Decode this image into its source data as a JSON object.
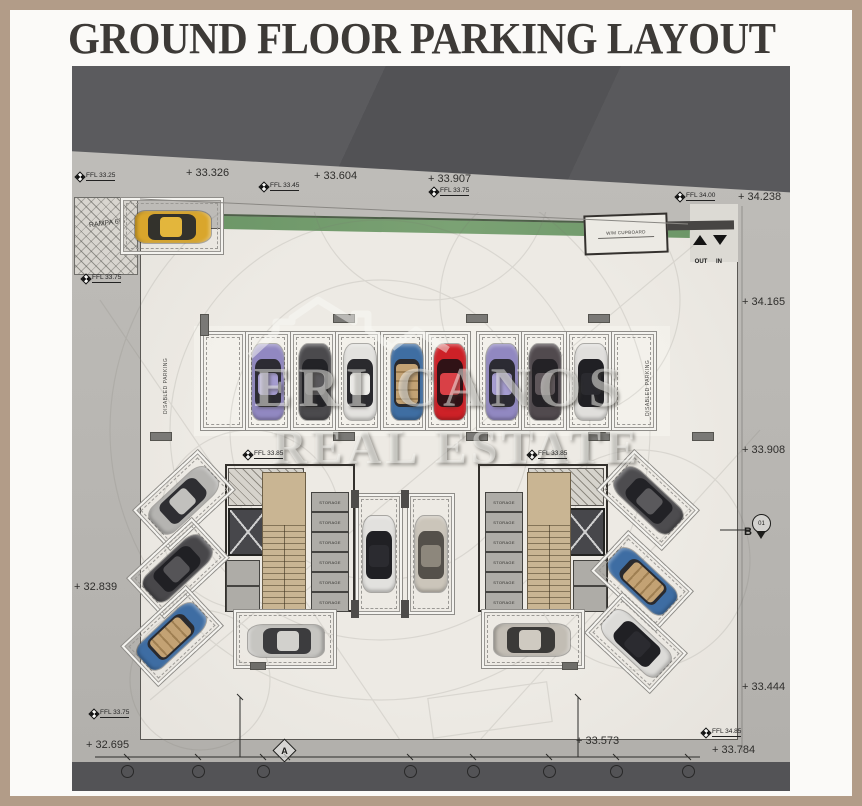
{
  "title": "GROUND FLOOR PARKING LAYOUT",
  "watermark": {
    "line1": "ERI CANOS",
    "line2": "REAL ESTATE"
  },
  "colors": {
    "frame": "#b29c88",
    "page": "#fbfaf8",
    "road": "#b6b4b0",
    "dark_band": "#57575a",
    "floor": "#eae7e1",
    "green_strip": "#6d9768",
    "car_yellow": "#d9a62c",
    "car_red": "#cd2127",
    "car_purple": "#9188c1",
    "car_blue": "#3f6ea2"
  },
  "plan": {
    "ramp_label": "RAMPA 6%",
    "cupboard_label": "W/M CUPBOARD",
    "out_label": "OUT",
    "in_label": "IN",
    "disabled_parking_left": "DISABLED PARKING",
    "disabled_parking_right": "DISABLED PARKING",
    "storage_label": "STORAGE",
    "elevations": [
      {
        "id": "top-1",
        "text": "+ 33.326"
      },
      {
        "id": "top-2",
        "text": "+ 33.604"
      },
      {
        "id": "top-3",
        "text": "+ 33.907"
      },
      {
        "id": "top-right",
        "text": "+ 34.238"
      },
      {
        "id": "right-1",
        "text": "+ 34.165"
      },
      {
        "id": "right-2",
        "text": "+ 33.908"
      },
      {
        "id": "right-3",
        "text": "+ 33.444"
      },
      {
        "id": "bottom-right",
        "text": "+ 33.784"
      },
      {
        "id": "bottom-mid",
        "text": "+ 33.573"
      },
      {
        "id": "left-1",
        "text": "+ 32.839"
      },
      {
        "id": "left-2",
        "text": "+ 32.695"
      }
    ],
    "ffl_markers": [
      {
        "id": "top-left",
        "text": "FFL 33.25"
      },
      {
        "id": "top-mid",
        "text": "FFL 33.45"
      },
      {
        "id": "top-mid2",
        "text": "FFL 33.75"
      },
      {
        "id": "entry",
        "text": "FFL 34.00"
      },
      {
        "id": "left-upper",
        "text": "FFL 33.75"
      },
      {
        "id": "core-left",
        "text": "FFL 33.85"
      },
      {
        "id": "core-right",
        "text": "FFL 33.85"
      },
      {
        "id": "bottom-left",
        "text": "FFL 33.75"
      },
      {
        "id": "bottom-right",
        "text": "FFL 34.85"
      }
    ],
    "grid": {
      "section_a": "A",
      "section_b": "B",
      "detail_bubble": "01"
    }
  }
}
